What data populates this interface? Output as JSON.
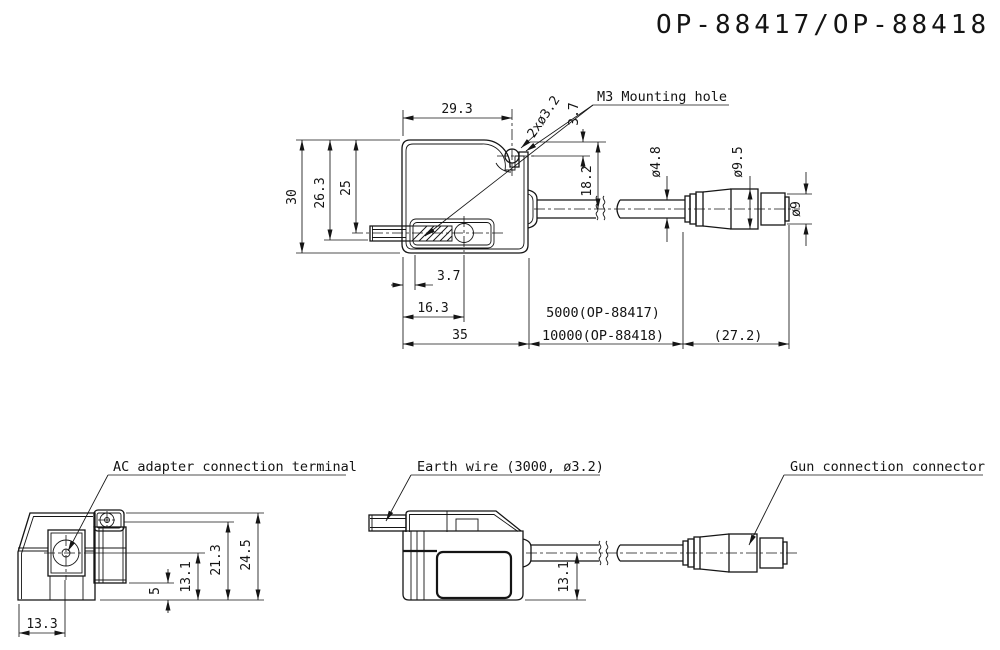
{
  "title": "OP-88417/OP-88418",
  "top_view": {
    "callouts": {
      "mounting_hole": "M3 Mounting hole",
      "hole_spec": "2xø3.2"
    },
    "dims": {
      "width_to_hole": "29.3",
      "hole_from_top": "3.7",
      "height_total": "30",
      "height_26_3": "26.3",
      "height_25": "25",
      "cable_from_top": "18.2",
      "cable_dia": "ø4.8",
      "connector_dia": "ø9.5",
      "tip_dia": "ø9",
      "offset_3_7": "3.7",
      "hole2_from_left": "16.3",
      "body_length": "35",
      "cable_length_op88417": "5000(OP-88417)",
      "cable_length_op88418": "10000(OP-88418)",
      "connector_length": "(27.2)"
    }
  },
  "ac_view": {
    "callout": "AC adapter connection terminal",
    "dims": {
      "terminal_from_left": "13.3",
      "step_height": "5",
      "terminal_height": "13.1",
      "screw_height": "21.3",
      "total_height": "24.5"
    }
  },
  "earth_view": {
    "callout": "Earth wire (3000, ø3.2)",
    "dims": {
      "cable_height": "13.1"
    }
  },
  "gun_view": {
    "callout": "Gun connection connector"
  }
}
